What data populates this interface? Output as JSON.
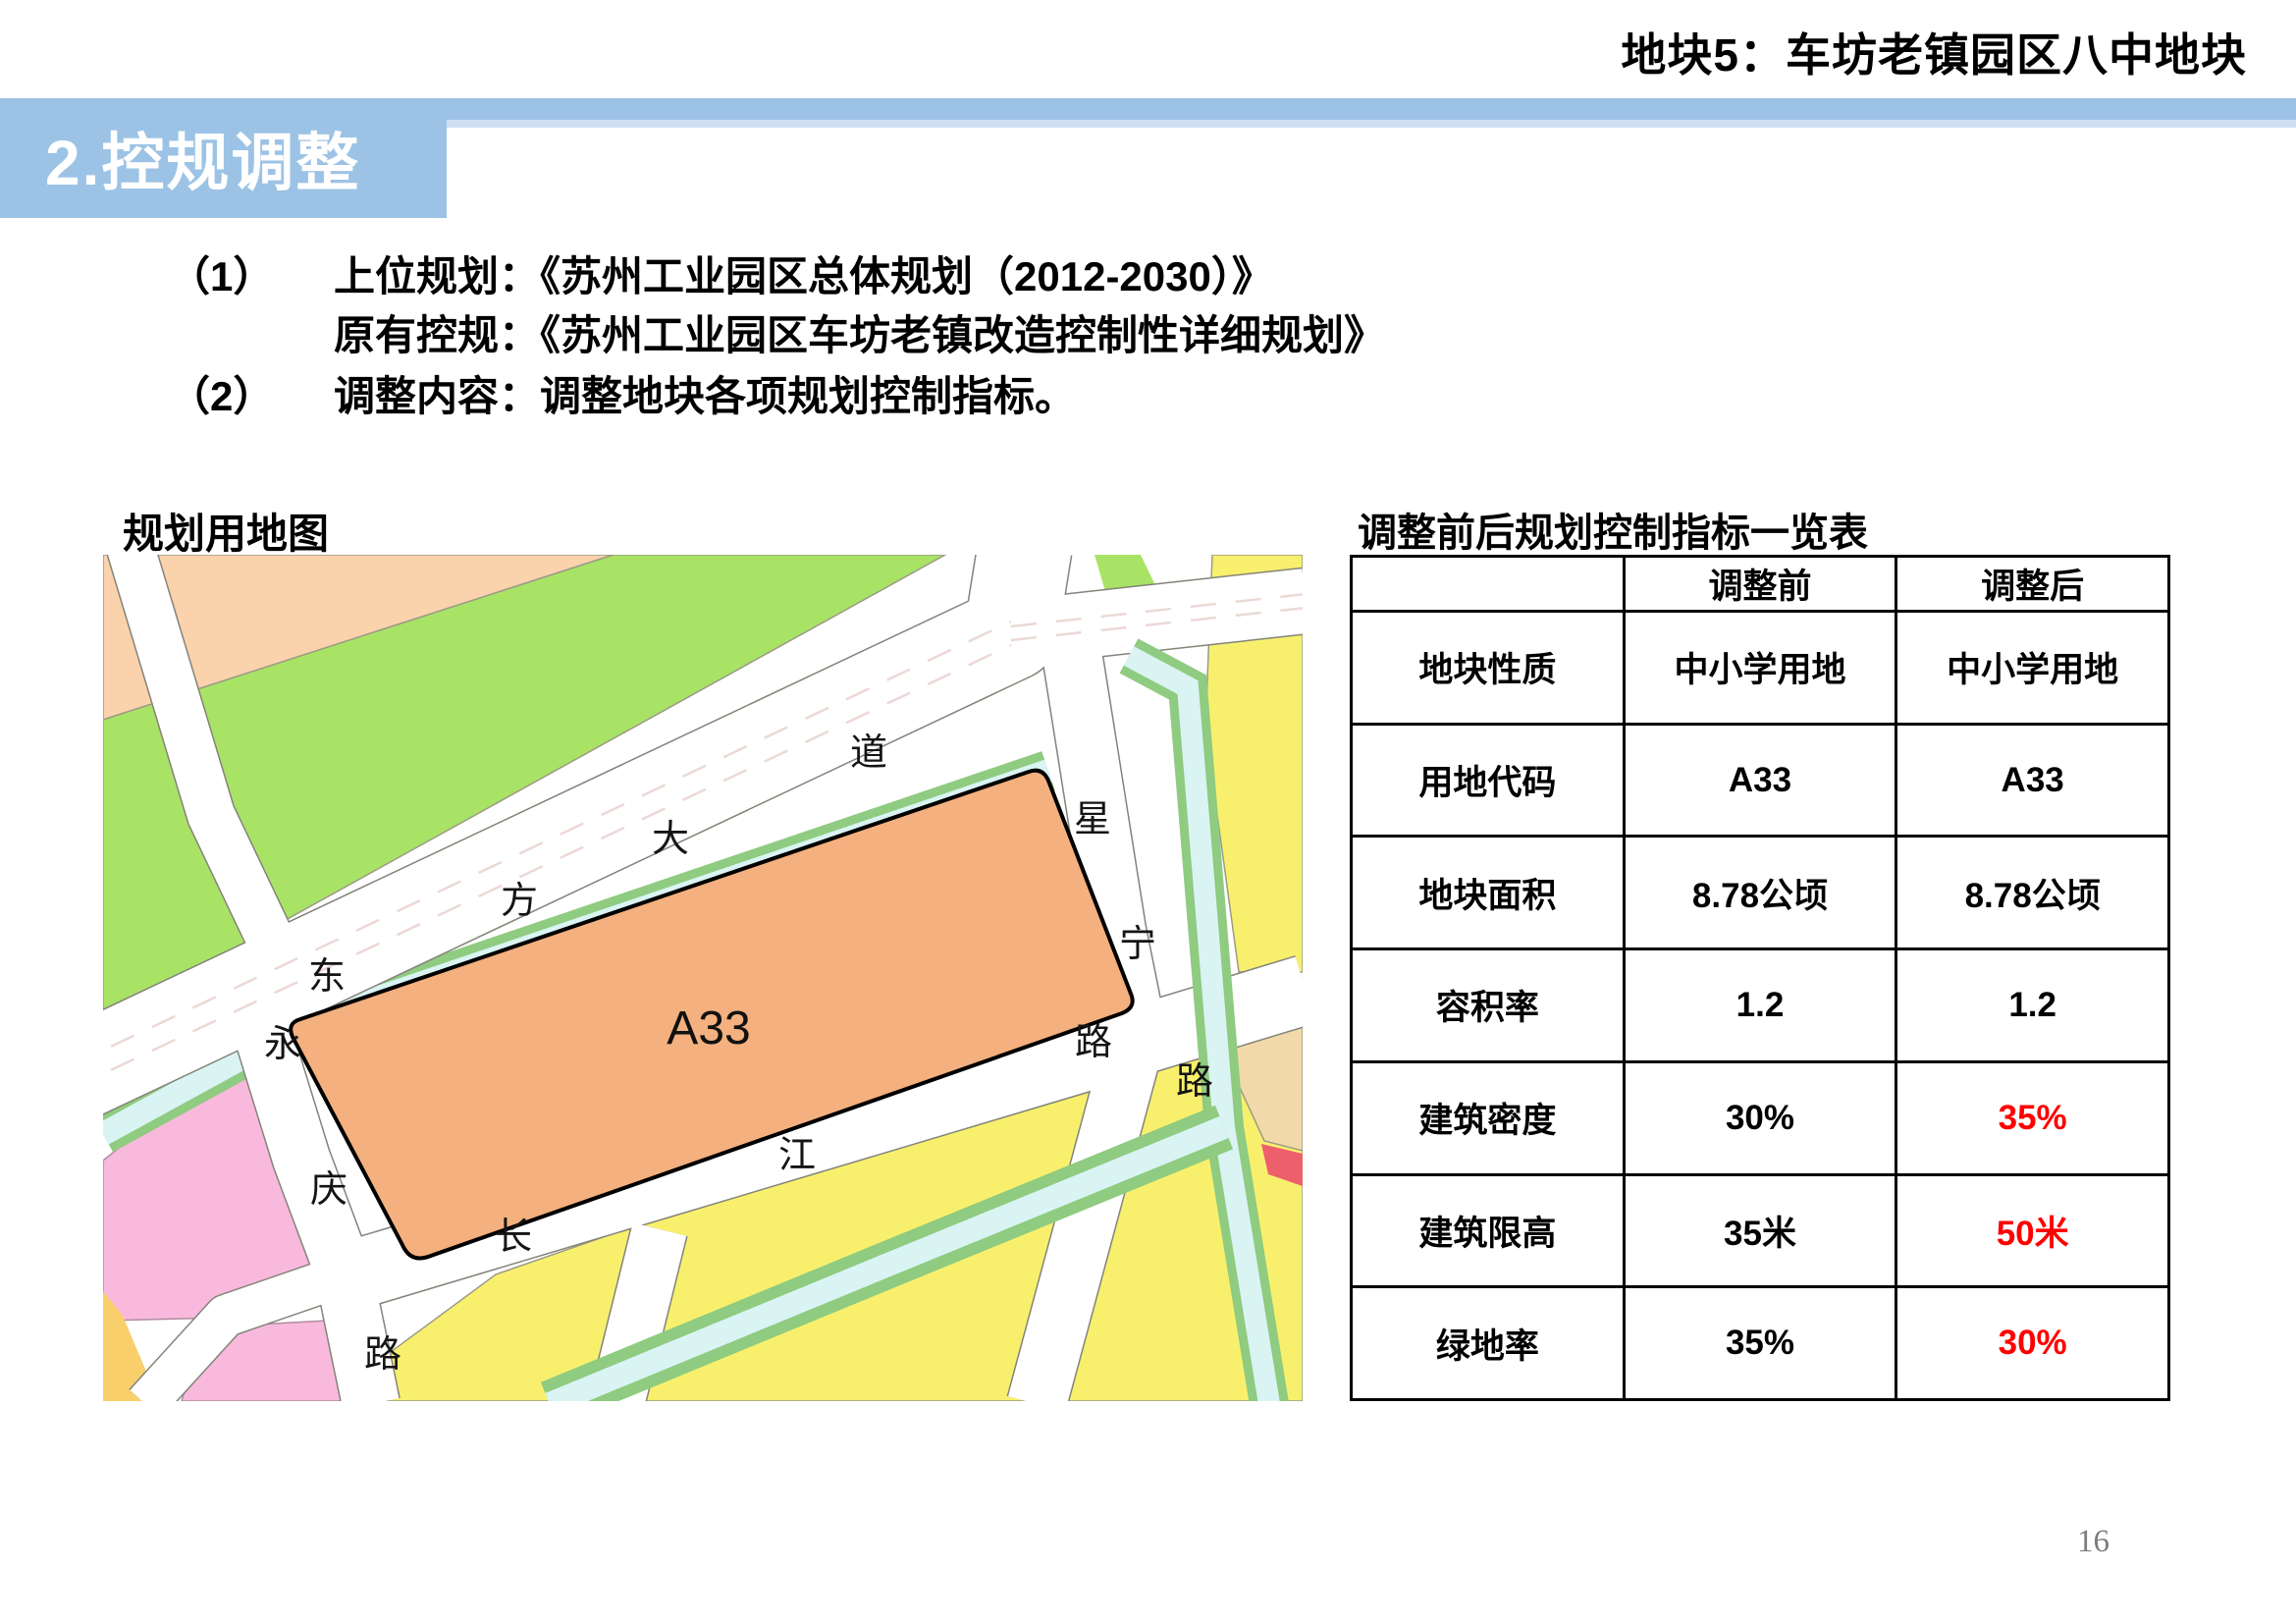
{
  "header": {
    "title": "地块5：车坊老镇园区八中地块"
  },
  "banner": {
    "section_title": "2.控规调整"
  },
  "body_text": {
    "line1": {
      "num": "（1）",
      "label": "上位规划：",
      "value": "《苏州工业园区总体规划（2012-2030）》"
    },
    "line2": {
      "label": "原有控规：",
      "value": "《苏州工业园区车坊老镇改造控制性详细规划》"
    },
    "line3": {
      "num": "（2）",
      "label": "调整内容：",
      "value": "调整地块各项规划控制指标。"
    }
  },
  "map": {
    "caption": "规划用地图",
    "plot_label": "A33",
    "road_labels": {
      "dongfang_avenue": [
        "东",
        "方",
        "大",
        "道"
      ],
      "xingning_road": [
        "星",
        "宁",
        "路"
      ],
      "changjiang_road": [
        "长",
        "江",
        "路"
      ],
      "yongqing_road": [
        "永",
        "庆",
        "路"
      ]
    },
    "colors": {
      "school_plot_orange": "#F4B07E",
      "plot_outline": "#000000",
      "residential_pink": "#F9B9DC",
      "green_space": "#A9E366",
      "peach_parcel": "#FAD2AC",
      "yellow_parcel": "#F8F06D",
      "mustard_parcel": "#F9CF6B",
      "tan_parcel": "#F2D9A9",
      "red_parcel": "#EE5F6C",
      "canal_water": "#D9F4F3",
      "canal_bank": "#8FCB80",
      "road_white": "#FFFFFF"
    }
  },
  "table": {
    "caption": "调整前后规划控制指标一览表",
    "columns": [
      "",
      "调整前",
      "调整后"
    ],
    "rows": [
      {
        "label": "地块性质",
        "before": "中小学用地",
        "after": "中小学用地",
        "after_red": false
      },
      {
        "label": "用地代码",
        "before": "A33",
        "after": "A33",
        "after_red": false
      },
      {
        "label": "地块面积",
        "before": "8.78公顷",
        "after": "8.78公顷",
        "after_red": false
      },
      {
        "label": "容积率",
        "before": "1.2",
        "after": "1.2",
        "after_red": false
      },
      {
        "label": "建筑密度",
        "before": "30%",
        "after": "35%",
        "after_red": true
      },
      {
        "label": "建筑限高",
        "before": "35米",
        "after": "50米",
        "after_red": true
      },
      {
        "label": "绿地率",
        "before": "35%",
        "after": "30%",
        "after_red": true
      }
    ],
    "highlight_color": "#FF0000"
  },
  "page_number": "16",
  "theme": {
    "banner_blue": "#9CC3E5",
    "banner_blue_light": "#CFE0F2",
    "text_black": "#000000",
    "page_number_gray": "#7D7D7D"
  }
}
